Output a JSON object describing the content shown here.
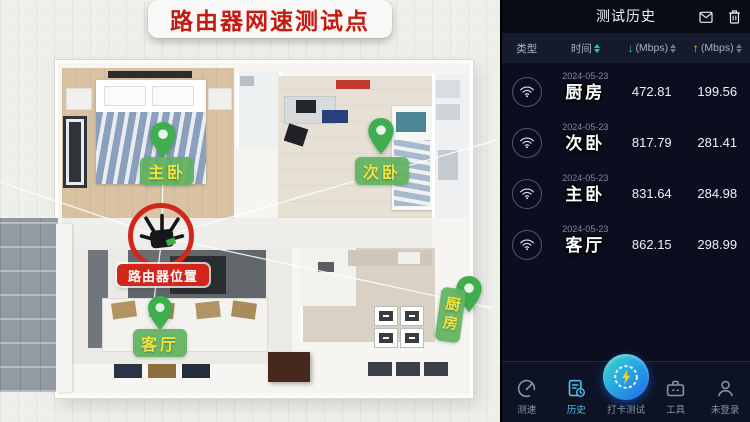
{
  "floorplan": {
    "title": "路由器网速测试点",
    "router_label": "路由器位置",
    "pins": [
      {
        "label": "主卧"
      },
      {
        "label": "次卧"
      },
      {
        "label": "客厅"
      },
      {
        "label": "厨房"
      }
    ],
    "colors": {
      "pin_green": "#3fae4f",
      "tag_bg": "#60b25e",
      "tag_text": "#f2e43c",
      "router_red": "#d3261a",
      "banner_text": "#c6190f"
    }
  },
  "app": {
    "title": "测试历史",
    "columns": {
      "type": "类型",
      "time": "时间",
      "down_glyph": "↓",
      "down": "(Mbps)",
      "up_glyph": "↑",
      "up": "(Mbps)"
    },
    "rows": [
      {
        "date": "2024-05-23",
        "location": "厨房",
        "download": "472.81",
        "upload": "199.56"
      },
      {
        "date": "2024-05-23",
        "location": "次卧",
        "download": "817.79",
        "upload": "281.41"
      },
      {
        "date": "2024-05-23",
        "location": "主卧",
        "download": "831.64",
        "upload": "284.98"
      },
      {
        "date": "2024-05-23",
        "location": "客厅",
        "download": "862.15",
        "upload": "298.99"
      }
    ],
    "nav": [
      {
        "label": "测速"
      },
      {
        "label": "历史"
      },
      {
        "label": "打卡测试"
      },
      {
        "label": "工具"
      },
      {
        "label": "未登录"
      }
    ],
    "colors": {
      "accent": "#4ec7ef",
      "down_arrow": "#1cc9a6",
      "up_arrow": "#ffd21e",
      "bg": "#0a0e1e"
    }
  }
}
